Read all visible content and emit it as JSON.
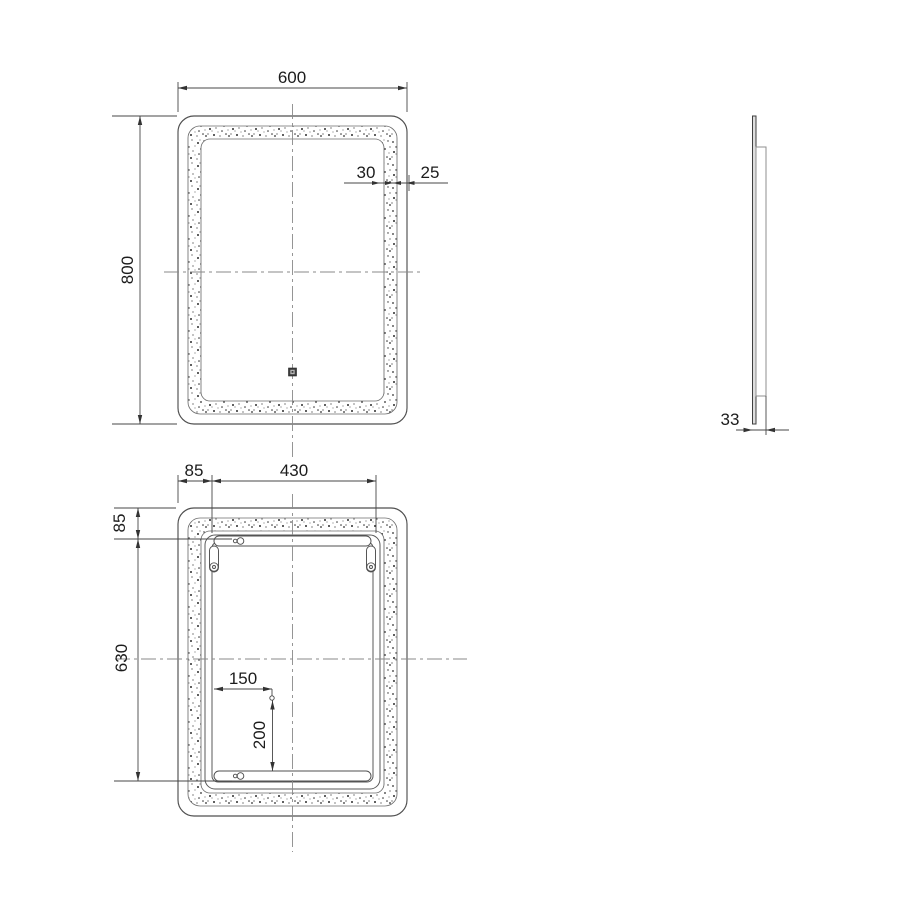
{
  "colors": {
    "background": "#ffffff",
    "object_line": "#4f4f4f",
    "dimension_line": "#474747",
    "centerline": "#8a8a8a",
    "speckle": "#2e2e2e",
    "text": "#1c1c1c"
  },
  "front": {
    "width": "600",
    "height": "800",
    "band_width": "30",
    "band_edge_gap": "25"
  },
  "side": {
    "depth": "33"
  },
  "back": {
    "bracket_side_offset": "85",
    "bracket_span": "430",
    "bracket_top_offset": "85",
    "bracket_vertical_span": "630",
    "cable_x": "150",
    "cable_y": "200"
  }
}
